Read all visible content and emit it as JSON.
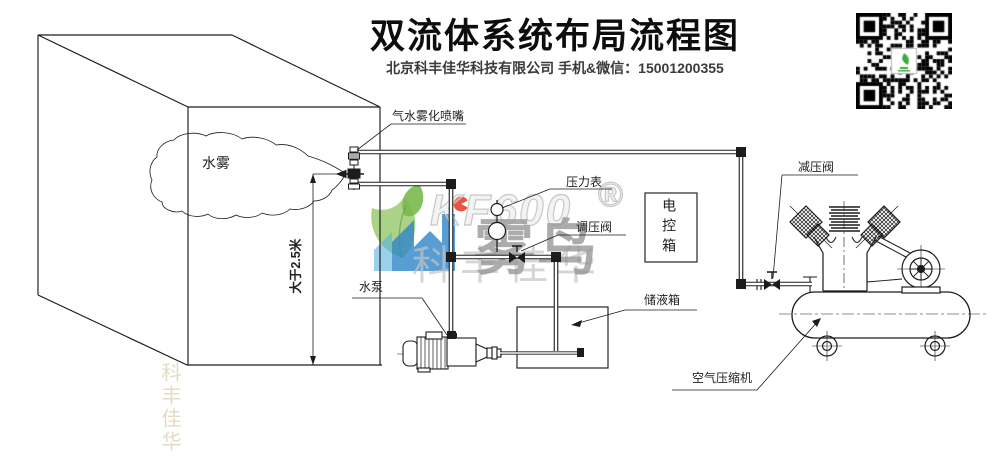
{
  "header": {
    "title": "双流体系统布局流程图",
    "subtitle": "北京科丰佳华科技有限公司 手机&微信：15001200355"
  },
  "labels": {
    "nozzle": "气水雾化喷嘴",
    "mist": "水雾",
    "min_height": "大于2.5米",
    "pressure_gauge": "压力表",
    "regulating_valve": "调压阀",
    "control_box": "电控箱",
    "storage_tank": "储液箱",
    "water_pump": "水泵",
    "reducing_valve": "减压阀",
    "air_compressor": "空气压缩机"
  },
  "watermark": {
    "brand": "KF600",
    "registered": "®",
    "wordmark": "雾鸟",
    "company_mark": "科丰佳华",
    "corner_mark": "科丰佳华"
  },
  "icons": {
    "qr_code": "wechat-qr-code",
    "leaf_logo": "leaf-logo",
    "brand_logo": "kf-logo"
  },
  "colors": {
    "line": "#1c1c1c",
    "leaf_green": "#8fc86b",
    "logo_blue": "#2e86c9",
    "dot_red": "#e8432f",
    "wm_dark": "#969696",
    "wm_light": "#c8c8c8"
  }
}
